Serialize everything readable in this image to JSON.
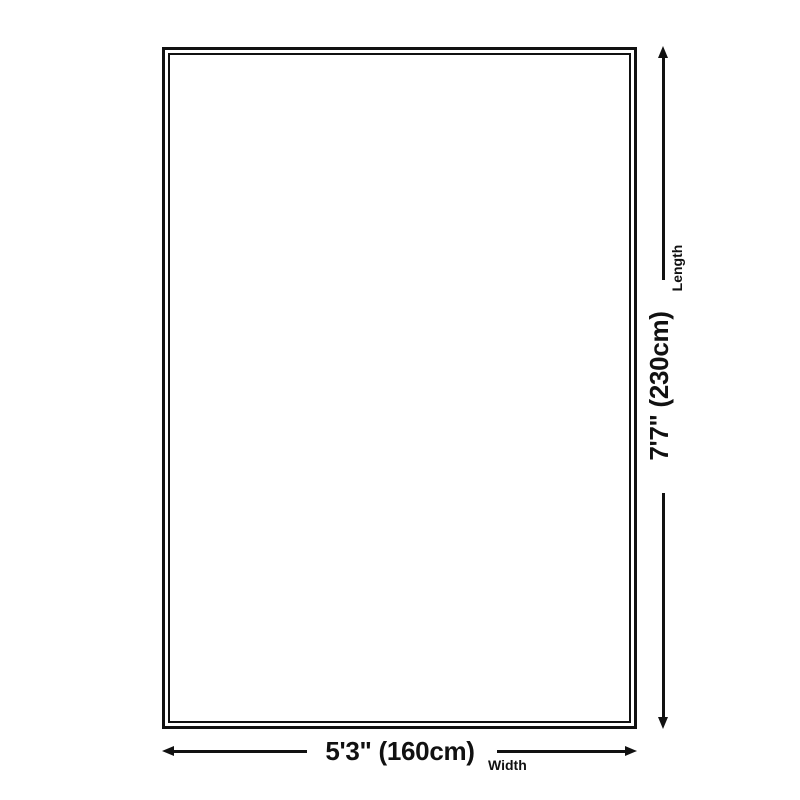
{
  "colors": {
    "ink": "#111111",
    "background": "#ffffff"
  },
  "diagram": {
    "length": {
      "label": "Length",
      "value": "7'7\" (230cm)"
    },
    "width": {
      "label": "Width",
      "value": "5'3\" (160cm)"
    }
  }
}
